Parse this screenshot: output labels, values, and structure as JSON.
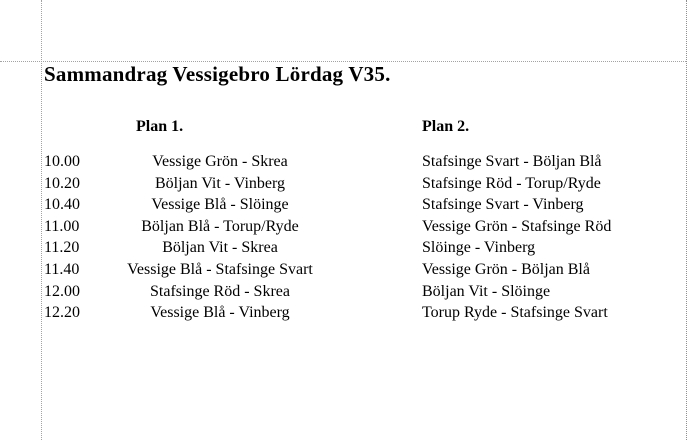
{
  "page": {
    "title": "Sammandrag Vessigebro Lördag V35."
  },
  "schedule": {
    "column_headers": {
      "plan1": "Plan 1.",
      "plan2": "Plan 2."
    },
    "rows": [
      {
        "time": "10.00",
        "plan1": "Vessige Grön - Skrea",
        "plan2": "Stafsinge Svart - Böljan Blå"
      },
      {
        "time": "10.20",
        "plan1": "Böljan Vit - Vinberg",
        "plan2": "Stafsinge Röd - Torup/Ryde"
      },
      {
        "time": "10.40",
        "plan1": "Vessige Blå - Slöinge",
        "plan2": "Stafsinge Svart - Vinberg"
      },
      {
        "time": "11.00",
        "plan1": "Böljan Blå - Torup/Ryde",
        "plan2": "Vessige Grön - Stafsinge Röd"
      },
      {
        "time": "11.20",
        "plan1": "Böljan Vit - Skrea",
        "plan2": "Slöinge - Vinberg"
      },
      {
        "time": "11.40",
        "plan1": "Vessige Blå - Stafsinge Svart",
        "plan2": "Vessige Grön - Böljan Blå"
      },
      {
        "time": "12.00",
        "plan1": "Stafsinge Röd - Skrea",
        "plan2": "Böljan Vit - Slöinge"
      },
      {
        "time": "12.20",
        "plan1": "Vessige Blå - Vinberg",
        "plan2": "Torup Ryde - Stafsinge Svart"
      }
    ]
  },
  "colors": {
    "background": "#ffffff",
    "text": "#000000",
    "guide_line": "#a3a3a3"
  }
}
